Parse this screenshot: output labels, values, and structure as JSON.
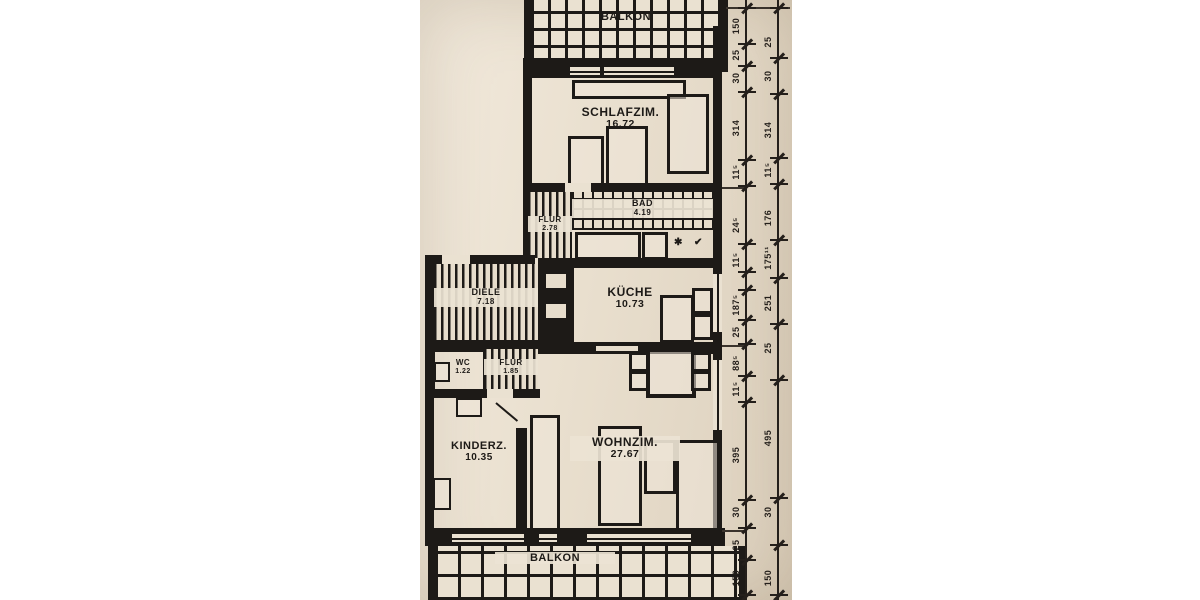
{
  "photo": {
    "paper_color": "#e9dfce",
    "ink_color": "#1d1a17",
    "description": "scanned apartment floor plan"
  },
  "rooms": {
    "balkon_top": {
      "label": "BALKON"
    },
    "schlafzimmer": {
      "label": "SCHLAFZIM.",
      "area": "16.72"
    },
    "flur_upper": {
      "label": "FLUR",
      "area": "2.78"
    },
    "bad": {
      "label": "BAD",
      "area": "4.19"
    },
    "diele": {
      "label": "DIELE",
      "area": "7.18"
    },
    "kueche": {
      "label": "KÜCHE",
      "area": "10.73"
    },
    "wc": {
      "label": "WC",
      "area": "1.22"
    },
    "flur_lower": {
      "label": "FLUR",
      "area": "1.85"
    },
    "kinderzimmer": {
      "label": "KINDERZ.",
      "area": "10.35"
    },
    "wohnzimmer": {
      "label": "WOHNZIM.",
      "area": "27.67"
    },
    "balkon_bottom": {
      "label": "BALKON"
    }
  },
  "icons": {
    "bad_fixture_star": "✱",
    "bad_fixture_hook": "✔"
  },
  "dimensions": {
    "inner_chain": [
      "150",
      "25",
      "30",
      "314",
      "11⁵",
      "24⁵",
      "11⁵",
      "187⁵",
      "25",
      "88⁵",
      "11⁵",
      "395",
      "30",
      "25",
      "150"
    ],
    "outer_chain": [
      "25",
      "30",
      "314",
      "11⁵",
      "176",
      "175¹¹",
      "251",
      "25",
      "495",
      "30",
      "150"
    ]
  }
}
